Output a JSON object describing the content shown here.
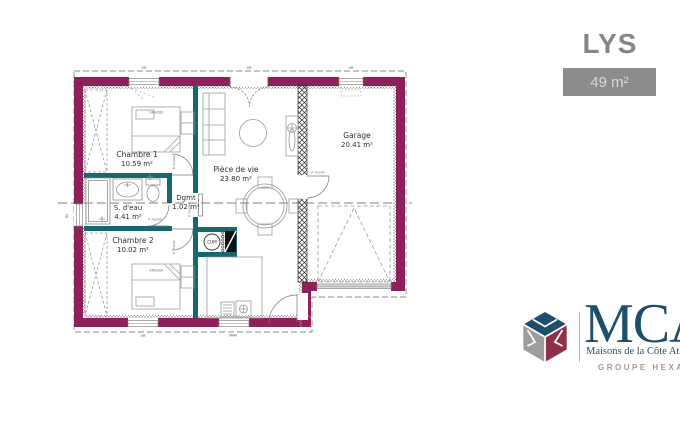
{
  "header": {
    "model_name": "LYS",
    "area_badge": "49 m²"
  },
  "plan": {
    "rooms": [
      {
        "name": "Chambre 1",
        "area": "10.59 m²"
      },
      {
        "name": "S. d'eau",
        "area": "4.41 m²"
      },
      {
        "name": "Chambre 2",
        "area": "10.02 m²"
      },
      {
        "name": "Dgmt",
        "area": "1.02 m²"
      },
      {
        "name": "Pièce de vie",
        "area": "23.80 m²"
      },
      {
        "name": "Garage",
        "area": "20.41 m²"
      }
    ],
    "water_heater_label": "CUM",
    "door_size_label": "P 75/204",
    "bed_size_label": "140x200",
    "window_label": "VR",
    "left_window_label": "60",
    "bottom_dimension_label": "9640"
  },
  "branding": {
    "logo_text": "MCA",
    "tagline": "Maisons de la Côte Atlantique",
    "group_label": "GROUPE HEXAOM"
  },
  "colors": {
    "outer_wall": "#8D2159",
    "interior_wall": "#156770",
    "badge_bg": "#8C8C8C",
    "brand_navy": "#1D4E6B",
    "brand_maroon": "#8E3049",
    "brand_gray": "#9E9E9E"
  }
}
